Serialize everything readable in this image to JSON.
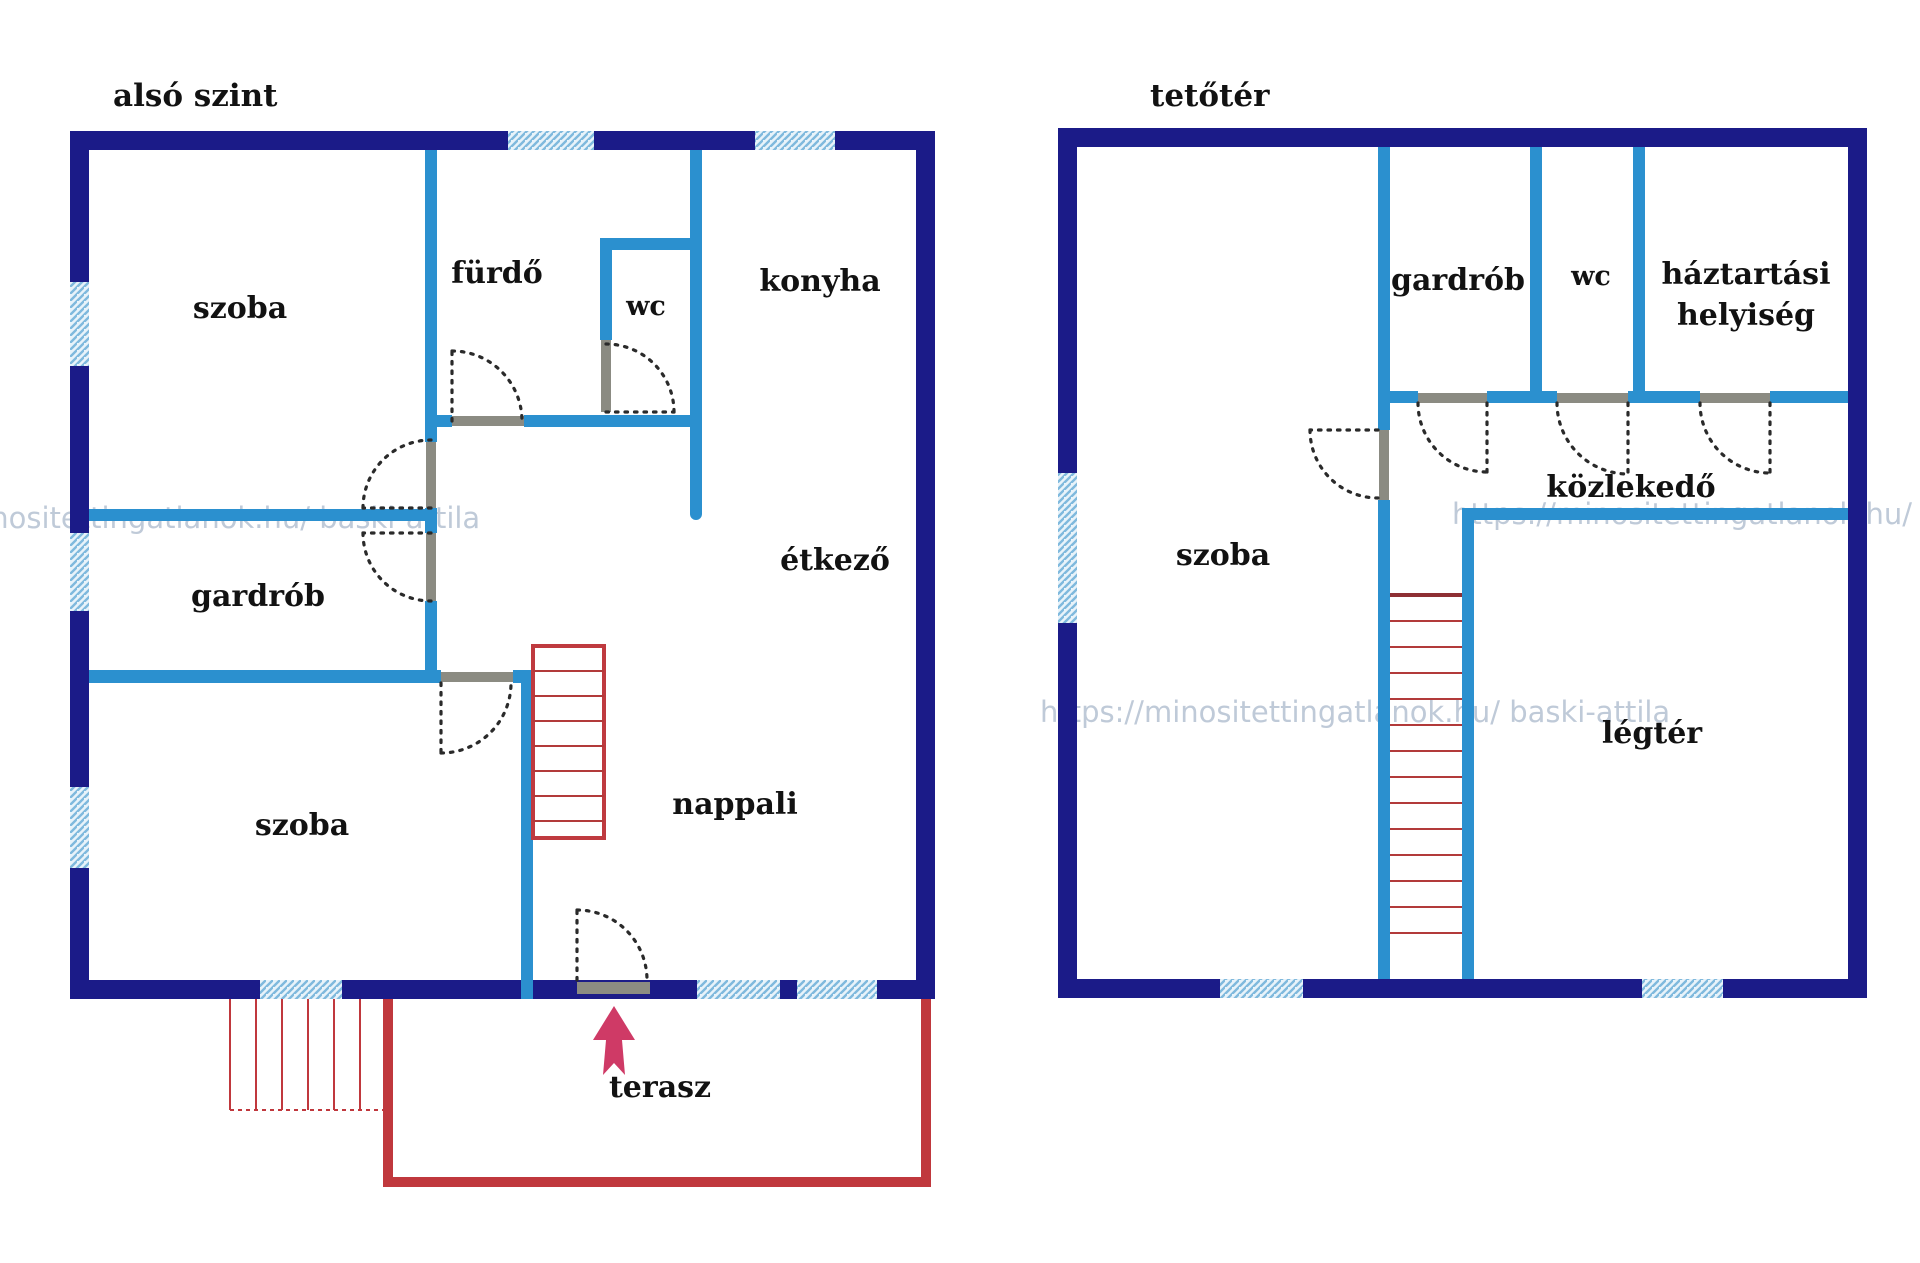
{
  "document": {
    "background": "#ffffff"
  },
  "colors": {
    "outer_wall": "#1b1b88",
    "inner_wall": "#2b90cf",
    "window_fill": "#e8f3fa",
    "window_stripe": "#7fb9dd",
    "stairs_red": "#bf3a3f",
    "terrace_red": "#c0383d",
    "door_sill": "#8b8b82",
    "door_arc": "#2a2a2a",
    "label_text": "#121212",
    "entrance_arrow": "#cf3a66",
    "watermark": "#bfcad8"
  },
  "floors": [
    {
      "title": "alsó szint",
      "rooms": [
        {
          "name": "szoba-upper",
          "label": "szoba"
        },
        {
          "name": "furdo",
          "label": "fürdő"
        },
        {
          "name": "wc",
          "label": "wc"
        },
        {
          "name": "konyha",
          "label": "konyha"
        },
        {
          "name": "etkezo",
          "label": "étkező"
        },
        {
          "name": "gardrob",
          "label": "gardrób"
        },
        {
          "name": "szoba-lower",
          "label": "szoba"
        },
        {
          "name": "nappali",
          "label": "nappali"
        },
        {
          "name": "terasz",
          "label": "terasz"
        }
      ]
    },
    {
      "title": "tetőtér",
      "rooms": [
        {
          "name": "szoba",
          "label": "szoba"
        },
        {
          "name": "gardrob",
          "label": "gardrób"
        },
        {
          "name": "wc",
          "label": "wc"
        },
        {
          "name": "haztartasi-helyiseg",
          "label": "háztartási",
          "label2": "helyiség"
        },
        {
          "name": "kozlekedo",
          "label": "közlekedő"
        },
        {
          "name": "legter",
          "label": "légtér"
        }
      ]
    }
  ],
  "watermark": {
    "text": "https://minositettingatlanok.hu/ baski-attila"
  }
}
